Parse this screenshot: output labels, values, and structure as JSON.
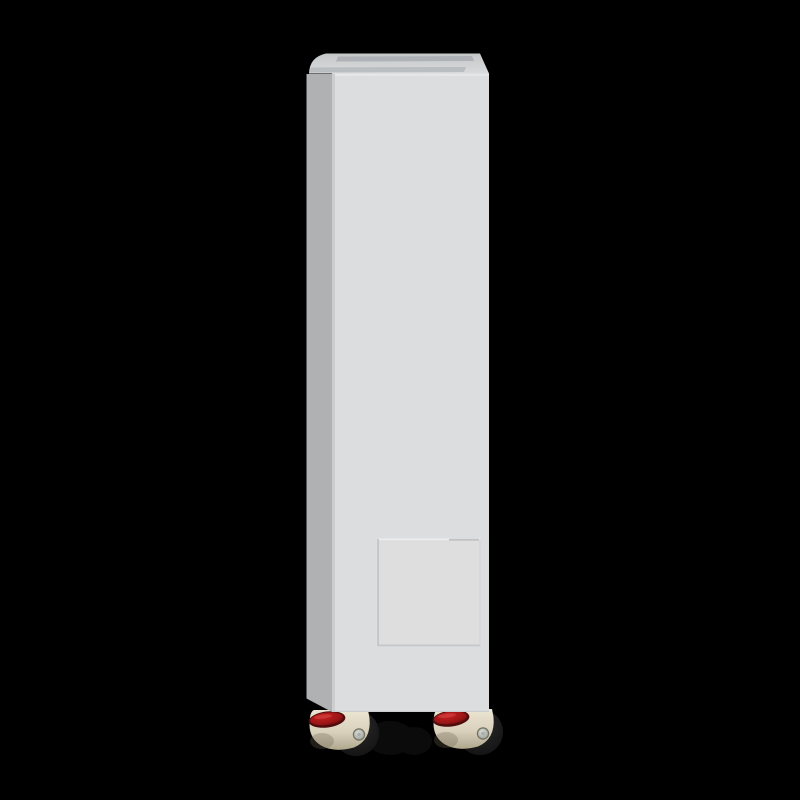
{
  "scene": {
    "label": "white-floor-standing-cabinet-on-leveling-casters",
    "background": "#000000"
  },
  "cabinet": {
    "front_face": "#dcddde",
    "side_face": "#b0b1b3",
    "corner_seam": "#c9cbcc",
    "top_back": "#c5c7c9",
    "top_front": "#d8dadb",
    "top_vent": "#a9adb1",
    "top_edge_highlight": "#e7e8e9",
    "bottom_edge": "#c2c3c5"
  },
  "panel": {
    "face": "#dededf",
    "edge_light": "#ecedee",
    "edge_dark": "#c0c2c4",
    "edge_faint": "#d3d4d6",
    "groove": "#b9bcbe"
  },
  "caster": {
    "housing_light": "#ece5d3",
    "housing_mid": "#d9d1bc",
    "housing_dark": "#b0a78e",
    "shadow": "#6d654f",
    "red_bright": "#c32121",
    "red_mid": "#9a1515",
    "red_dark": "#4f0c0d",
    "red_highlight": "#dd4b4b",
    "wheel_rim": "#2a2a2a",
    "wheel": "#101010",
    "bolt_edge": "#72715f",
    "bolt_light": "#dadddb",
    "bolt_dark": "#8f948e",
    "bolt_inner": "#a9aca6",
    "rear_hint": "#0b0b0b"
  }
}
